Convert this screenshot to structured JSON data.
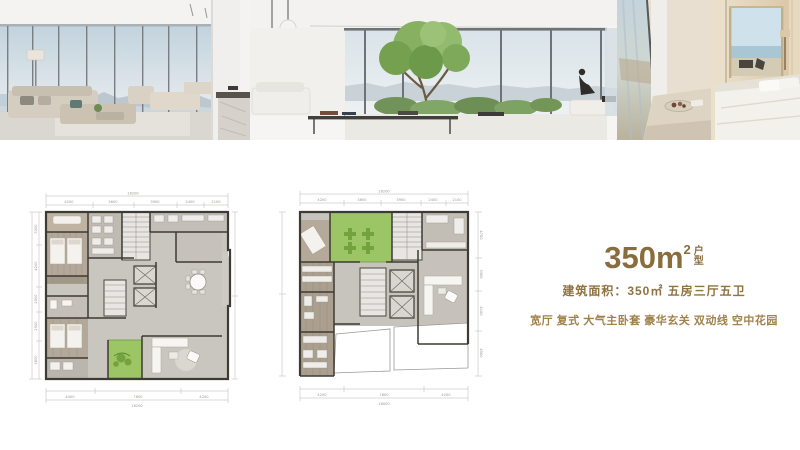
{
  "page": {
    "background": "#ffffff"
  },
  "gallery": {
    "photos": [
      {
        "name": "living-room-skyline-photo"
      },
      {
        "name": "terrace-tree-photo"
      },
      {
        "name": "bedroom-sea-view-photo"
      }
    ]
  },
  "info": {
    "accent_color": "#8a6d3c",
    "accent_light": "#a0824c",
    "area_value": "350",
    "area_unit": "m",
    "area_sup": "2",
    "type_char_top": "户",
    "type_char_bottom": "型",
    "detail_line": "建筑面积：350㎡ 五房三厅五卫",
    "features_line": "宽厅 复式 大气主卧套 豪华玄关 双动线 空中花园"
  },
  "floorplans": {
    "left": {
      "top_total": "16200",
      "top_segments": [
        "4200",
        "3600",
        "3900",
        "2400",
        "2100"
      ],
      "left_segments": [
        "3300",
        "4200",
        "2500",
        "2900",
        "3800"
      ],
      "bottom_total": "16200",
      "bottom_segments": [
        "4400",
        "7600",
        "4200"
      ]
    },
    "right": {
      "top_total": "16200",
      "top_segments": [
        "4200",
        "3600",
        "3900",
        "2400",
        "2100"
      ],
      "right_segments": [
        "4700",
        "3300",
        "4100",
        "4500"
      ],
      "bottom_total": "16000",
      "bottom_segments": [
        "4200",
        "7600",
        "4200"
      ]
    },
    "colors": {
      "wall": "#3e3a34",
      "floor": "#c9c6c0",
      "wood": "#b3a899",
      "garden_green": "#9cc566",
      "plant_green": "#74a33e"
    }
  }
}
